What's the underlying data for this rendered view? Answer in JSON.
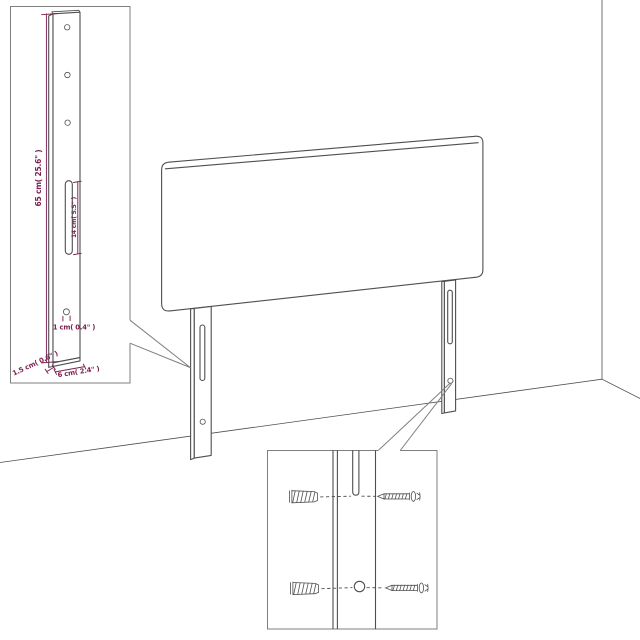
{
  "colors": {
    "line": "#4f4f4f",
    "box": "#7f7f7f",
    "dimension": "#7c2150",
    "background": "#ffffff"
  },
  "diagram": {
    "subject": "Headboard with two slotted mounting legs shown against a room corner, with a leg-dimension detail inset and a wall-plug/screw hardware detail inset",
    "dimensions": {
      "leg_height": "65 cm( 25.6\" )",
      "slot_length": "14 cm( 5.5\" )",
      "hole_diameter": "1 cm( 0.4\" )",
      "leg_depth": "1.5 cm( 0.6\" )",
      "leg_width": "6 cm( 2.4\" )"
    }
  }
}
